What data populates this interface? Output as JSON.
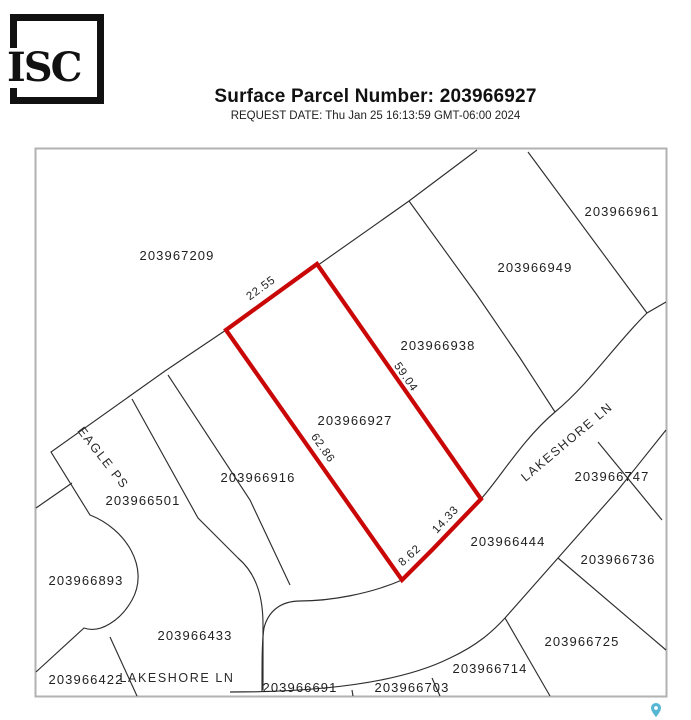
{
  "header": {
    "logo_text": "ISC",
    "title": "Surface Parcel Number: 203966927",
    "request_date": "REQUEST DATE: Thu Jan 25 16:13:59 GMT-06:00 2024"
  },
  "map": {
    "selected_parcel": "203966927",
    "highlight_color": "#c90707",
    "dimension_color": "#c9524e",
    "line_color": "#2e2e2e",
    "border_color": "#b2b2b2",
    "pin_color": "#56b7d4",
    "parcels": [
      "203967209",
      "203966961",
      "203966949",
      "203966938",
      "203966927",
      "203966916",
      "203966501",
      "203966893",
      "203966433",
      "203966422",
      "203966691",
      "203966703",
      "203966714",
      "203966725",
      "203966736",
      "203966747",
      "203966444"
    ],
    "streets": {
      "eagle_ps": "EAGLE PS",
      "lakeshore_ln_upper": "LAKESHORE LN",
      "lakeshore_ln_lower": "LAKESHORE LN"
    },
    "dimensions": [
      "22.55",
      "59.04",
      "62.86",
      "14.33",
      "8.62"
    ],
    "icons": [
      "map-pin-icon"
    ]
  }
}
